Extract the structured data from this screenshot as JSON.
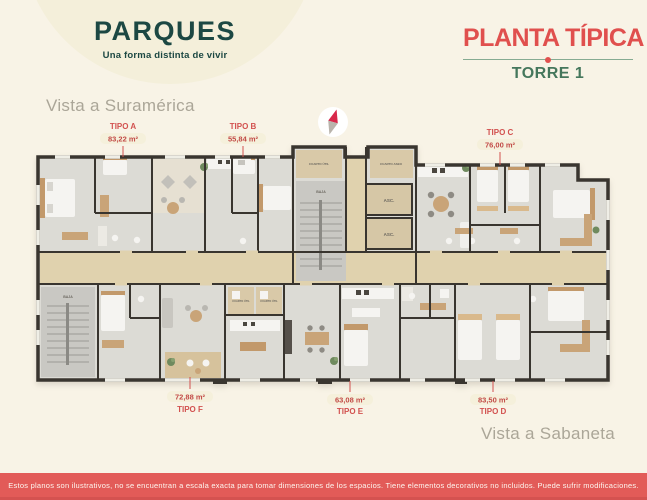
{
  "brand": {
    "name": "PARQUES",
    "tagline": "Una forma distinta de vivir"
  },
  "header": {
    "title": "PLANTA TÍPICA",
    "tower": "TORRE 1"
  },
  "views": {
    "north": "Vista a Suramérica",
    "south": "Vista a Sabaneta"
  },
  "units": {
    "a": {
      "name": "TIPO A",
      "area": "83,22 m²"
    },
    "b": {
      "name": "TIPO B",
      "area": "55,84 m²"
    },
    "c": {
      "name": "TIPO C",
      "area": "76,00 m²"
    },
    "d": {
      "name": "TIPO D",
      "area": "83,50 m²"
    },
    "e": {
      "name": "TIPO E",
      "area": "63,08 m²"
    },
    "f": {
      "name": "TIPO F",
      "area": "72,88 m²"
    }
  },
  "plan_labels": {
    "elevator": "ASC.",
    "stairs_down": "BAJA",
    "utility_room": "CUARTO ÚTIL",
    "cleaning_room": "CUARTO ASEO"
  },
  "footer": {
    "disclaimer": "Estos planos son ilustrativos, no se encuentran a escala exacta para tomar dimensiones de los espacios. Tiene elementos decorativos no incluidos. Puede sufrir modificaciones."
  },
  "colors": {
    "accent_red": "#E0504E",
    "brand_green": "#1C4843",
    "tower_green": "#45775C",
    "background_cream": "#F8F3E6",
    "footer_red": "#E25B58",
    "wall_dark": "#39352F"
  }
}
